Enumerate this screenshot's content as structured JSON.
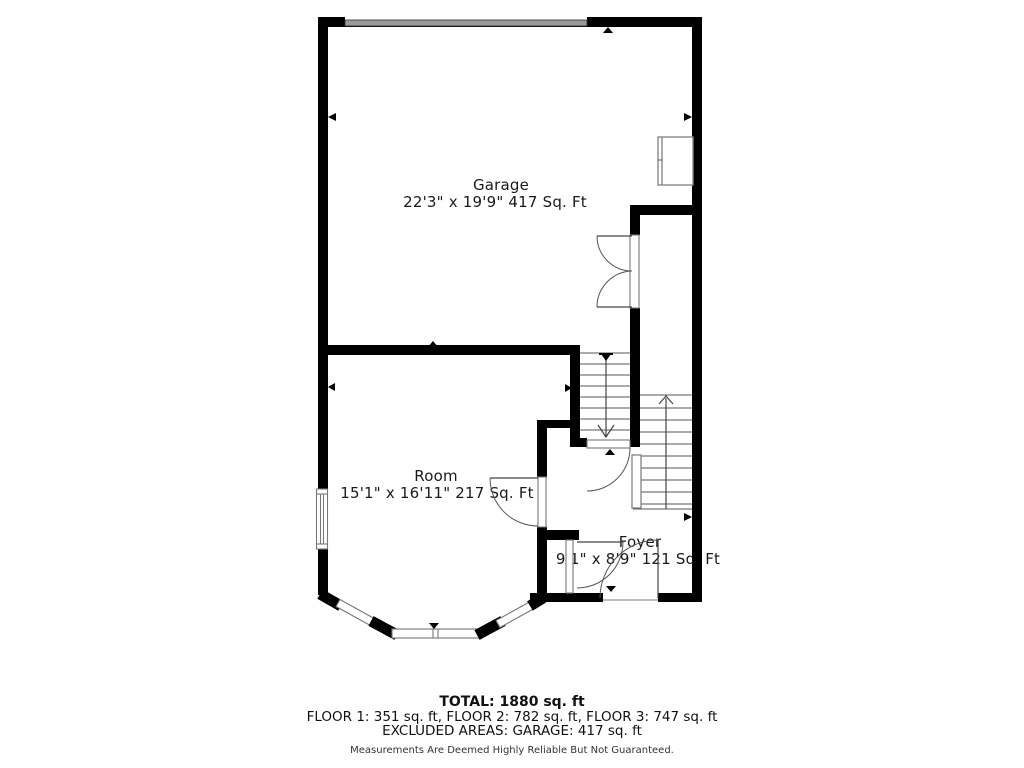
{
  "rooms": {
    "garage": {
      "name": "Garage",
      "dimensions": "22'3\" x 19'9\" 417 Sq. Ft"
    },
    "room": {
      "name": "Room",
      "dimensions": "15'1\" x 16'11\" 217 Sq. Ft"
    },
    "foyer": {
      "name": "Foyer",
      "dimensions": "9'1\" x 8'9\" 121 Sq. Ft"
    }
  },
  "summary": {
    "total": "TOTAL: 1880 sq. ft",
    "floors": "FLOOR 1: 351 sq. ft, FLOOR 2: 782 sq. ft, FLOOR 3: 747 sq. ft",
    "excluded": "EXCLUDED AREAS: GARAGE: 417 sq. ft",
    "disclaimer": "Measurements Are Deemed Highly Reliable But Not Guaranteed."
  },
  "colors": {
    "wall": "#000000",
    "garage_door": "#999999",
    "thin_line": "#555555",
    "text": "#1a1a1a"
  }
}
